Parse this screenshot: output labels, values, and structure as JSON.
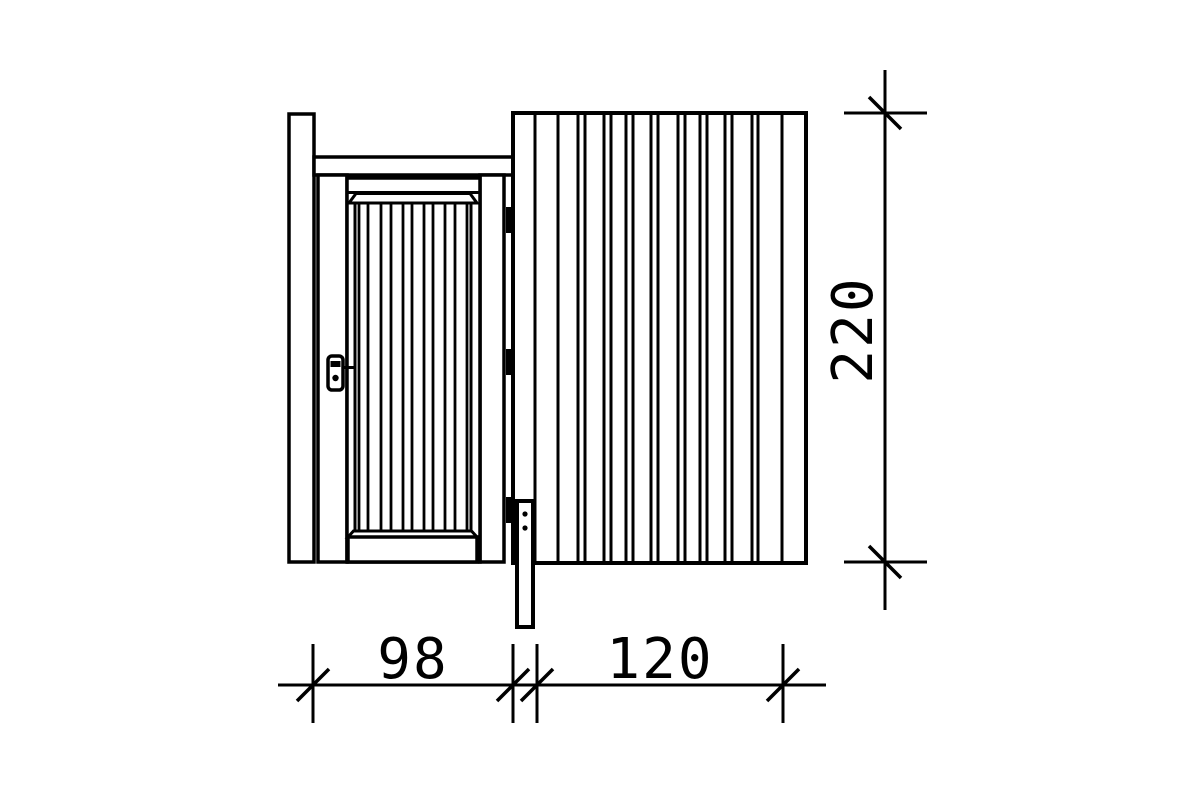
{
  "drawing": {
    "description": "Technical elevation drawing of a side wall element with single door (left) and vertical-plank wall panel (right)",
    "colors": {
      "line": "#000000",
      "background": "#ffffff",
      "hinge_fill": "#000000"
    },
    "parts": {
      "left_post": "left post",
      "top_rail": "top rail over door",
      "door_frame": "door frame",
      "door_leaf": "plank door leaf",
      "wall_panel": "vertical plank wall panel",
      "center_post": "center post below door frame",
      "lock": "door lock with handle",
      "hinges": "door hinges"
    },
    "dimensions": {
      "door_width": {
        "label": "98",
        "value": 98,
        "orientation": "horizontal"
      },
      "panel_width": {
        "label": "120",
        "value": 120,
        "orientation": "horizontal"
      },
      "overall_height": {
        "label": "220",
        "value": 220,
        "orientation": "vertical"
      }
    },
    "generated": {
      "line_groups": [
        {
          "parent": "door-planks",
          "name": "door-plank-line",
          "axis": "v",
          "positions": [
            359,
            368,
            381,
            391,
            403,
            412,
            424,
            433,
            445,
            455,
            467
          ],
          "from": 203,
          "to": 531,
          "w": 2.8
        },
        {
          "parent": "panel-planks",
          "name": "wall-plank-line",
          "axis": "v",
          "positions": [
            535,
            558,
            578,
            585,
            604,
            611,
            626,
            633,
            651,
            658,
            678,
            685,
            700,
            707,
            725,
            732,
            752,
            758,
            782
          ],
          "from": 115,
          "to": 561,
          "w": 3
        },
        {
          "parent": "dim-h-ticks",
          "name": "dimension-tick",
          "axis": "v",
          "positions": [
            313,
            513,
            537,
            783
          ],
          "from": 644,
          "to": 723,
          "w": 3
        },
        {
          "parent": "dim-v-ticks",
          "name": "dimension-tick",
          "axis": "h",
          "positions": [
            113,
            562
          ],
          "from": 844,
          "to": 927,
          "w": 3
        }
      ],
      "slash_groups": [
        {
          "parent": "dim-h-slashes",
          "name": "dimension-slash",
          "on": "h",
          "positions": [
            313,
            513,
            537,
            783
          ],
          "y": 685,
          "d": 16,
          "w": 3.5
        },
        {
          "parent": "dim-v-slashes",
          "name": "dimension-slash",
          "on": "v",
          "positions": [
            113,
            562
          ],
          "x": 885,
          "d": 16,
          "w": 3.5
        }
      ],
      "hinges": {
        "parent": "hinges",
        "name": "door-hinge",
        "x": 506,
        "w": 7,
        "h": 26,
        "y_positions": [
          207,
          349,
          497
        ]
      },
      "dots": {
        "parent": "center-post-screws",
        "name": "screw-dot",
        "cx": 525,
        "r": 2.6,
        "cy_positions": [
          514,
          528
        ]
      }
    }
  }
}
